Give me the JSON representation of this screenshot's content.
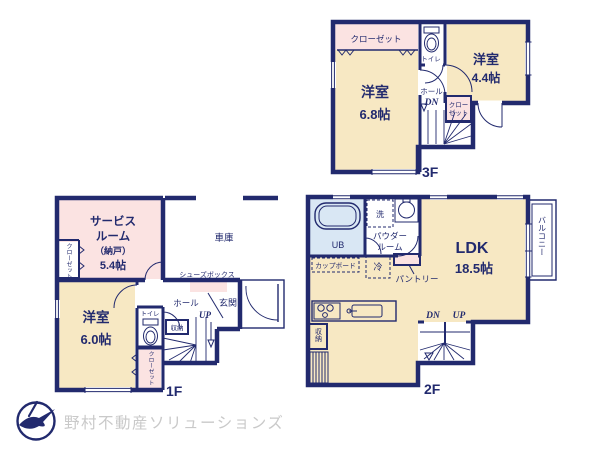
{
  "brand": "野村不動産ソリューションズ",
  "colors": {
    "wall": "#222a6e",
    "room_yellow": "#f7e8c3",
    "room_pink": "#fbe3e2",
    "room_blue": "#d9e7f4",
    "logo_text": "#c9c9c9"
  },
  "floor3": {
    "label": "3F",
    "closet_top": "クローゼット",
    "toilet": "トイレ",
    "room_a_name": "洋室",
    "room_a_size": "6.8帖",
    "room_b_name": "洋室",
    "room_b_size": "4.4帖",
    "hall": "ホール",
    "dn": "DN",
    "closet_side_line1": "クロー",
    "closet_side_line2": "ゼット"
  },
  "floor2": {
    "label": "2F",
    "unit_bath": "UB",
    "washer": "洗",
    "powder_line1": "パウダー",
    "powder_line2": "ルーム",
    "ldk_name": "LDK",
    "ldk_size": "18.5帖",
    "balcony": "バルコニー",
    "cupboard": "カップボード",
    "fridge": "冷",
    "pantry": "パントリー",
    "storage": "収納",
    "dn": "DN",
    "up": "UP"
  },
  "floor1": {
    "label": "1F",
    "service_line1": "サービス",
    "service_line2": "ルーム",
    "service_line3": "（納戸）",
    "service_size": "5.4帖",
    "closet_left": "クローゼット",
    "garage": "車庫",
    "shoes_box": "シューズボックス",
    "hall": "ホール",
    "entrance": "玄関",
    "up": "UP",
    "storage": "収納",
    "toilet": "トイレ",
    "room_name": "洋室",
    "room_size": "6.0帖",
    "closet_bottom": "クローゼット"
  }
}
